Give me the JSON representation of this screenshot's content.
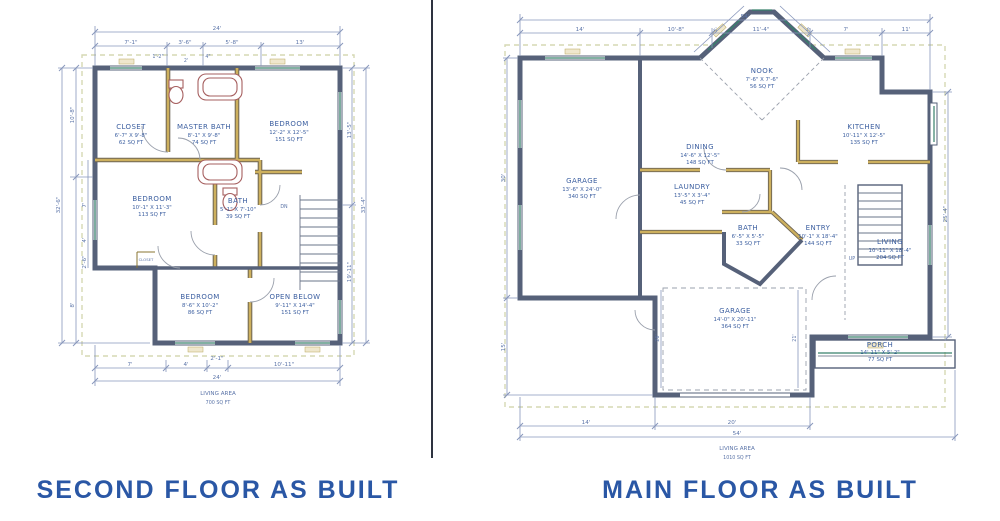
{
  "left": {
    "title": "SECOND FLOOR AS BUILT",
    "rooms": [
      {
        "name": "CLOSET",
        "dims": "6'-7\" X 9'-8\"",
        "area": "62 SQ FT"
      },
      {
        "name": "MASTER BATH",
        "dims": "8'-1\" X 9'-8\"",
        "area": "74 SQ FT"
      },
      {
        "name": "BEDROOM",
        "dims": "12'-2\" X 12'-5\"",
        "area": "151 SQ FT"
      },
      {
        "name": "BEDROOM",
        "dims": "10'-1\" X 11'-3\"",
        "area": "113 SQ FT"
      },
      {
        "name": "BATH",
        "dims": "5'-1\" X 7'-10\"",
        "area": "39 SQ FT"
      },
      {
        "name": "BEDROOM",
        "dims": "8'-6\" X 10'-2\"",
        "area": "86 SQ FT"
      },
      {
        "name": "OPEN BELOW",
        "dims": "9'-11\" X 14'-4\"",
        "area": "151 SQ FT"
      }
    ],
    "closet_small_label": "CLOSET",
    "stairs_label": "DN",
    "living_area_label": "LIVING AREA",
    "living_area_value": "700 SQ FT",
    "dims": {
      "top_total": "24'",
      "top_segments": [
        "7'-1\"",
        "3'-6\"",
        "5'-8\"",
        "13'"
      ],
      "top_small": [
        "1'-2\"",
        "2'",
        "4\""
      ],
      "bottom_segments": [
        "7'",
        "4'",
        "2'-1\"",
        "10'-11\""
      ],
      "bottom_total": "24'",
      "left_total": "32'-6\"",
      "left_segments": [
        "10'-8\"",
        "7'",
        "4'",
        "2'-6\"",
        "8'"
      ],
      "right_segments": [
        "13'-5\"",
        "19'-11\""
      ],
      "right_total": "33'-4\""
    }
  },
  "right": {
    "title": "MAIN FLOOR AS BUILT",
    "rooms": [
      {
        "name": "NOOK",
        "dims": "7'-6\" X 7'-6\"",
        "area": "56 SQ FT"
      },
      {
        "name": "DINING",
        "dims": "14'-6\" X 12'-5\"",
        "area": "148 SQ FT"
      },
      {
        "name": "KITCHEN",
        "dims": "10'-11\" X 12'-5\"",
        "area": "135 SQ FT"
      },
      {
        "name": "GARAGE",
        "dims": "13'-6\" X 24'-0\"",
        "area": "340 SQ FT"
      },
      {
        "name": "LAUNDRY",
        "dims": "13'-5\" X 3'-4\"",
        "area": "45 SQ FT"
      },
      {
        "name": "BATH",
        "dims": "6'-5\" X 5'-5\"",
        "area": "33 SQ FT"
      },
      {
        "name": "ENTRY",
        "dims": "10'-1\" X 18'-4\"",
        "area": "144 SQ FT"
      },
      {
        "name": "LIVING",
        "dims": "10'-11\" X 18'-4\"",
        "area": "204 SQ FT"
      },
      {
        "name": "GARAGE",
        "dims": "14'-0\" X 20'-11\"",
        "area": "364 SQ FT"
      },
      {
        "name": "PORCH",
        "dims": "14'-11\" X 5'-2\"",
        "area": "77 SQ FT"
      }
    ],
    "stairs_label": "UP",
    "living_area_label": "LIVING AREA",
    "living_area_value": "1010 SQ FT",
    "dims": {
      "top_total": "54'",
      "top_segments": [
        "14'",
        "10'-8\"",
        "11'-4\"",
        "7'",
        "11'"
      ],
      "diag_segments": [
        "5'",
        "5'"
      ],
      "left_segments": [
        "30'",
        "15'"
      ],
      "right_segments": [
        "25'-4\""
      ],
      "interior_segments": [
        "26'",
        "21'"
      ],
      "bottom_segments": [
        "14'",
        "20'"
      ],
      "bottom_total": "54'"
    }
  },
  "colors": {
    "wall": "#566179",
    "interior_wall": "#c7a64b",
    "dimension": "#5b74a8",
    "room_text": "#3c5fa0",
    "title_text": "#2a57a5",
    "window_accent": "#37806b",
    "overhang_dash": "#d5d8b4",
    "fixture": "#a65f5f"
  }
}
